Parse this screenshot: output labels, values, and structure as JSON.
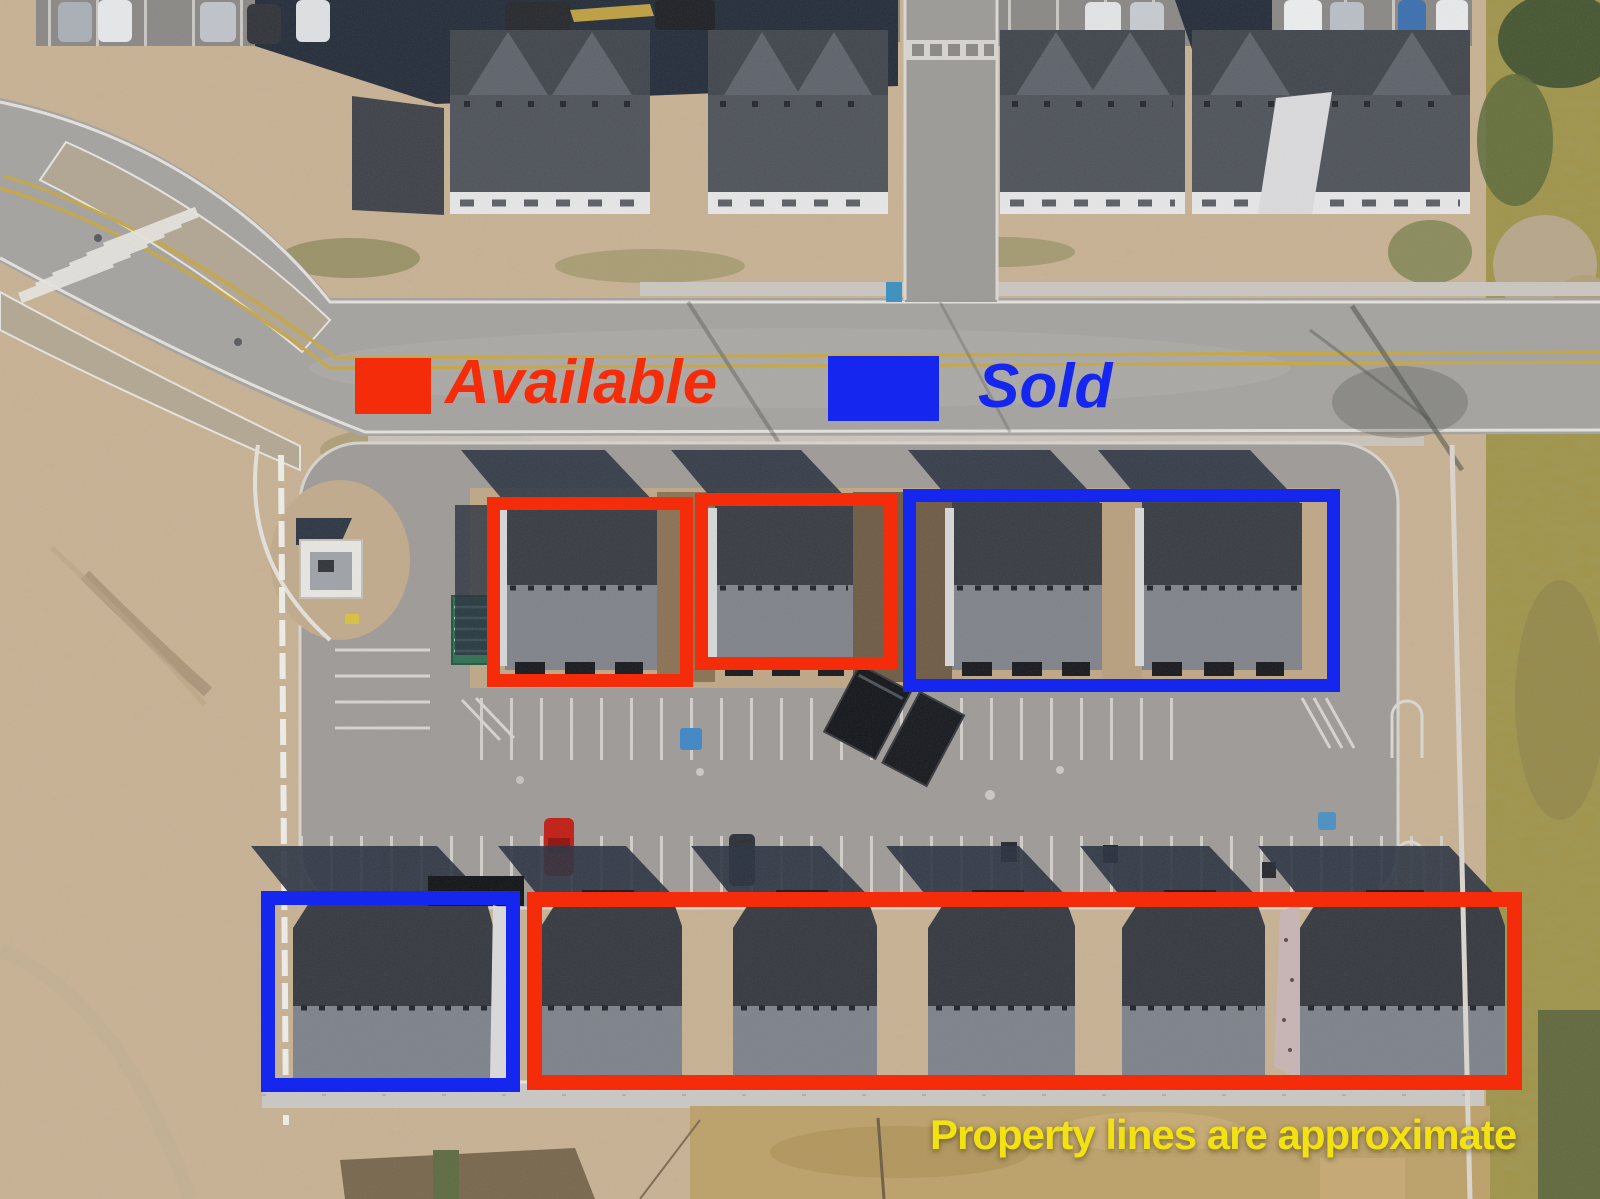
{
  "legend": {
    "available_label": "Available",
    "sold_label": "Sold",
    "available_color": "#f52c0a",
    "sold_color": "#1527ee"
  },
  "caption": {
    "text": "Property lines are approximate",
    "color": "#f2e212"
  },
  "annotations": {
    "boxes": [
      {
        "name": "outline-center-unit-1",
        "status": "available",
        "x": 487,
        "y": 497,
        "w": 206,
        "h": 190,
        "border": 13
      },
      {
        "name": "outline-center-unit-2",
        "status": "available",
        "x": 695,
        "y": 493,
        "w": 202,
        "h": 177,
        "border": 13
      },
      {
        "name": "outline-center-units-sold-pair",
        "status": "sold",
        "x": 903,
        "y": 489,
        "w": 437,
        "h": 203,
        "border": 13
      },
      {
        "name": "outline-bottom-left-unit",
        "status": "sold",
        "x": 261,
        "y": 891,
        "w": 259,
        "h": 201,
        "border": 14
      },
      {
        "name": "outline-bottom-row-units",
        "status": "available",
        "x": 527,
        "y": 892,
        "w": 995,
        "h": 198,
        "border": 15
      }
    ]
  }
}
